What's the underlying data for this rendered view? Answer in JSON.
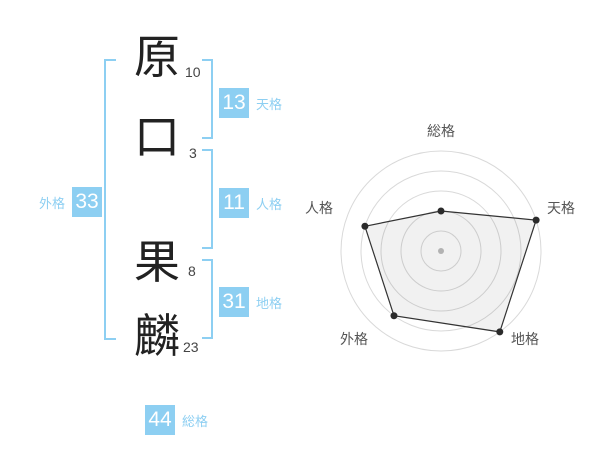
{
  "colors": {
    "accent": "#8DCFF2",
    "chart_ring": "#D9D9D9",
    "chart_line": "#333333",
    "chart_fill": "rgba(0,0,0,0.055)",
    "chart_point": "#2B2B2B",
    "chart_center_dot": "#BDBDBD",
    "chart_label": "#555555"
  },
  "name_panel": {
    "characters": [
      {
        "char": "原",
        "strokes": "10"
      },
      {
        "char": "口",
        "strokes": "3"
      },
      {
        "char": "果",
        "strokes": "8"
      },
      {
        "char": "麟",
        "strokes": "23"
      }
    ],
    "badges": {
      "tenkaku": {
        "value": "13",
        "label": "天格"
      },
      "jinkaku": {
        "value": "11",
        "label": "人格"
      },
      "chikaku": {
        "value": "31",
        "label": "地格"
      },
      "gaikaku": {
        "value": "33",
        "label": "外格"
      },
      "soukaku": {
        "value": "44",
        "label": "総格"
      }
    }
  },
  "chart_data": {
    "type": "radar",
    "categories": [
      "総格",
      "天格",
      "地格",
      "外格",
      "人格"
    ],
    "values": [
      2,
      5,
      5,
      4,
      4
    ],
    "max": 5,
    "rings": 5,
    "grid": "circular",
    "legend": "none",
    "title": ""
  }
}
